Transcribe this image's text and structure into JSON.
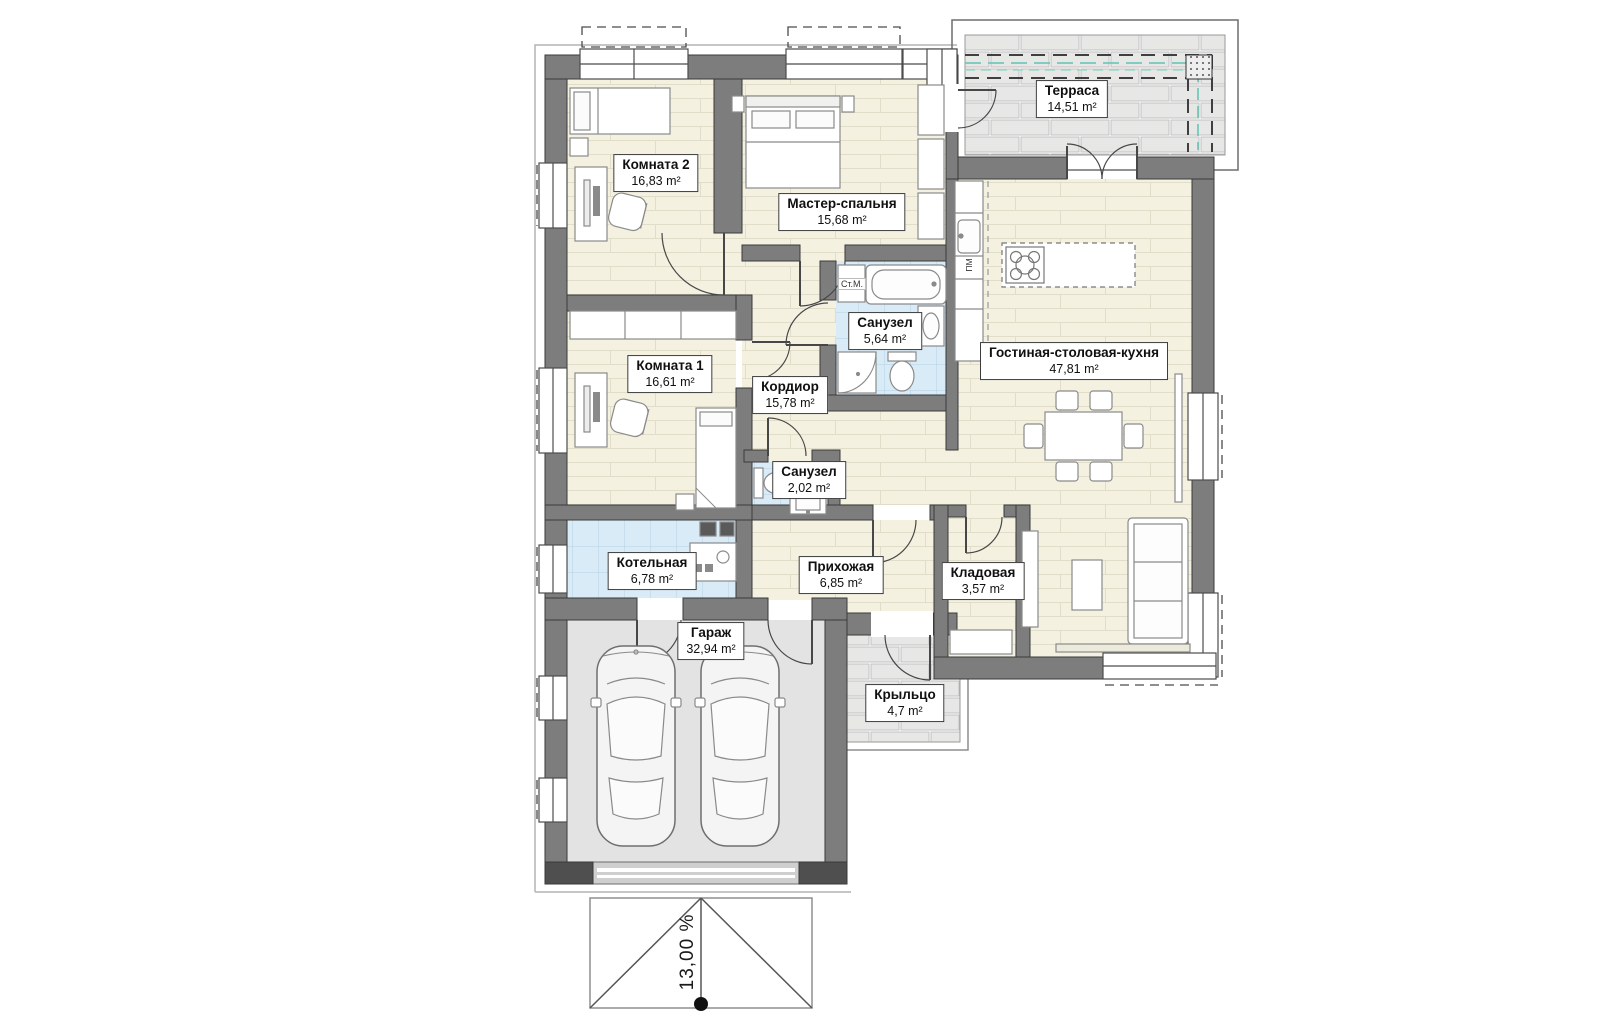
{
  "rooms": [
    {
      "id": "terrace",
      "name": "Терраса",
      "area": "14,51 m²"
    },
    {
      "id": "room2",
      "name": "Комната 2",
      "area": "16,83 m²"
    },
    {
      "id": "master",
      "name": "Мастер-спальня",
      "area": "15,68 m²"
    },
    {
      "id": "bath_main",
      "name": "Санузел",
      "area": "5,64 m²"
    },
    {
      "id": "room1",
      "name": "Комната 1",
      "area": "16,61 m²"
    },
    {
      "id": "corridor",
      "name": "Кордиор",
      "area": "15,78 m²"
    },
    {
      "id": "living",
      "name": "Гостиная-столовая-кухня",
      "area": "47,81 m²"
    },
    {
      "id": "bath_small",
      "name": "Санузел",
      "area": "2,02 m²"
    },
    {
      "id": "boiler",
      "name": "Котельная",
      "area": "6,78 m²"
    },
    {
      "id": "hall",
      "name": "Прихожая",
      "area": "6,85 m²"
    },
    {
      "id": "storage",
      "name": "Кладовая",
      "area": "3,57 m²"
    },
    {
      "id": "garage",
      "name": "Гараж",
      "area": "32,94 m²"
    },
    {
      "id": "porch",
      "name": "Крыльцо",
      "area": "4,7 m²"
    }
  ],
  "annotations": {
    "slope": "13,00 %",
    "washing_machine": "Ст.М.",
    "dishwasher": "ПМ"
  },
  "colors": {
    "wall": "#7d7d7d",
    "floor_wood": "#f4f1e1",
    "floor_tile": "#d9ebf7",
    "floor_garage": "#e3e3e3",
    "brick": "#e7e7e6",
    "railing_accent": "#5fc4b2"
  }
}
